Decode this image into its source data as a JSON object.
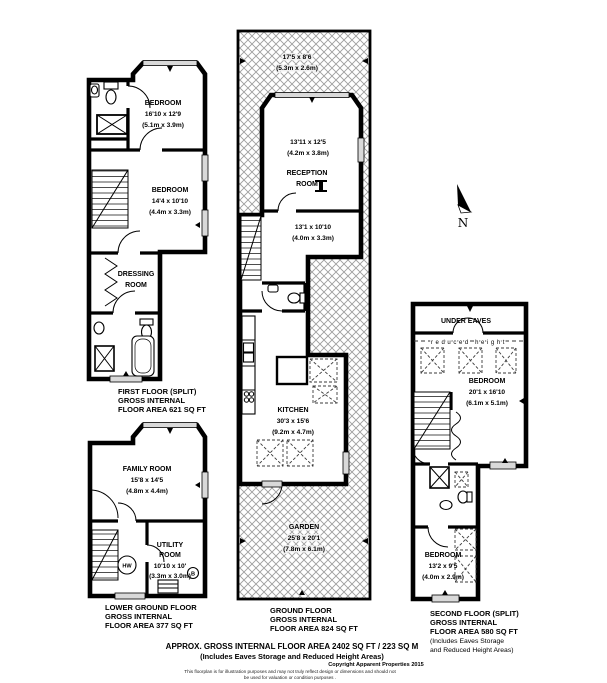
{
  "north": {
    "letter": "N"
  },
  "first_floor": {
    "bedroom1": {
      "name": "BEDROOM",
      "ft": "16'10 x 12'9",
      "m": "(5.1m x 3.9m)"
    },
    "bedroom2": {
      "name": "BEDROOM",
      "ft": "14'4 x 10'10",
      "m": "(4.4m x 3.3m)"
    },
    "dressing_line1": "DRESSING",
    "dressing_line2": "ROOM",
    "label": [
      "FIRST FLOOR (SPLIT)",
      "GROSS INTERNAL",
      "FLOOR AREA 621 SQ FT"
    ]
  },
  "lower_ground": {
    "family": {
      "name": "FAMILY ROOM",
      "ft": "15'8 x 14'5",
      "m": "(4.8m x 4.4m)"
    },
    "utility_line1": "UTILITY",
    "utility_line2": "ROOM",
    "utility_ft": "10'10 x 10'",
    "utility_m": "(3.3m x 3.0m)",
    "hw": "HW",
    "boiler": "B",
    "label": [
      "LOWER GROUND FLOOR",
      "GROSS INTERNAL",
      "FLOOR AREA 377 SQ FT"
    ]
  },
  "ground": {
    "terrace": {
      "ft": "17'5 x 8'6",
      "m": "(5.3m x 2.6m)"
    },
    "reception_upper": {
      "ft": "13'11 x 12'5",
      "m": "(4.2m x 3.8m)"
    },
    "reception_name1": "RECEPTION",
    "reception_name2": "ROOM",
    "reception_lower": {
      "ft": "13'1 x 10'10",
      "m": "(4.0m x 3.3m)"
    },
    "kitchen": {
      "name": "KITCHEN",
      "ft": "30'3 x 15'6",
      "m": "(9.2m x 4.7m)"
    },
    "garden": {
      "name": "GARDEN",
      "ft": "25'8 x 20'1",
      "m": "(7.8m x 6.1m)"
    },
    "label": [
      "GROUND FLOOR",
      "GROSS INTERNAL",
      "FLOOR AREA 824 SQ FT"
    ]
  },
  "second_floor": {
    "under_eaves": "UNDER EAVES",
    "reduced_height": "reduced height",
    "bedroom_upper": {
      "name": "BEDROOM",
      "ft": "20'1 x 16'10",
      "m": "(6.1m x 5.1m)"
    },
    "bedroom_lower": {
      "name": "BEDROOM",
      "ft": "13'2 x 9'5",
      "m": "(4.0m x 2.9m)"
    },
    "label": [
      "SECOND FLOOR (SPLIT)",
      "GROSS INTERNAL",
      "FLOOR AREA 580 SQ FT",
      "(Includes Eaves Storage",
      "and Reduced Height Areas)"
    ]
  },
  "footer": {
    "line1": "APPROX. GROSS INTERNAL FLOOR AREA 2402 SQ FT / 223 SQ M",
    "line2": "(Includes Eaves Storage and Reduced Height Areas)",
    "copyright": "Copyright Apparent Properties 2015",
    "disclaimer1": "This floorplan is for illustration purposes and may not truly reflect design or dimensions and should not",
    "disclaimer2": "be used for valuation or condition purposes ."
  }
}
